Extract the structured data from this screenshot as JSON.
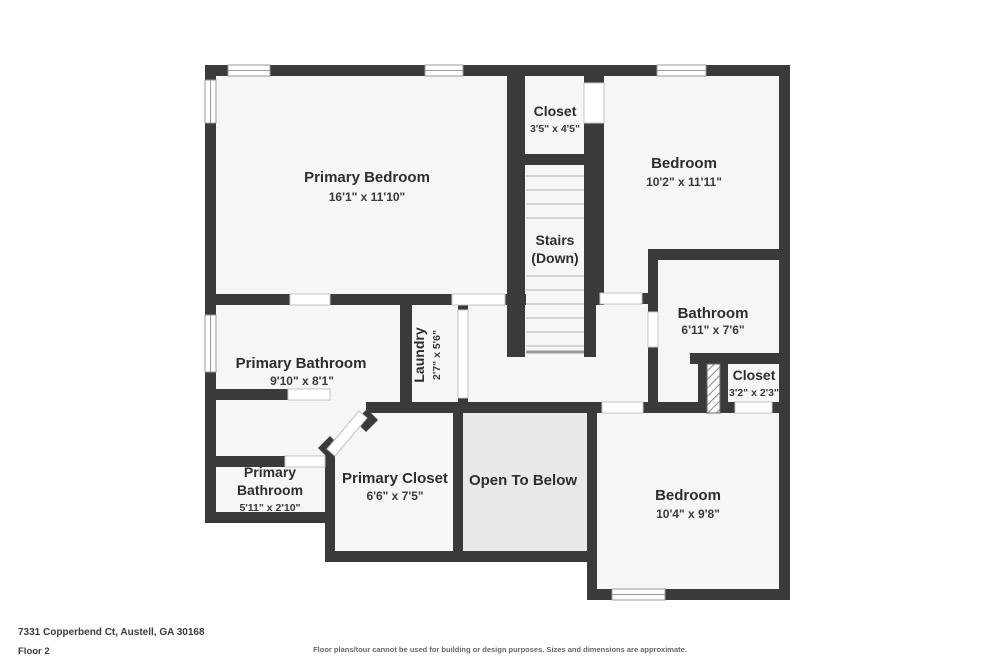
{
  "meta": {
    "title": "Floor plan - Floor 2",
    "colors": {
      "wall": "#3a3a3a",
      "room_fill": "#f6f6f6",
      "open_to_below_fill": "#e9e9e9",
      "step_line": "#c9c9c9",
      "window_outline": "#9a9a9a",
      "background": "#ffffff"
    }
  },
  "floorplan": {
    "rooms": [
      {
        "id": "primary-bedroom",
        "name": "Primary Bedroom",
        "dims": "16'1\" x 11'10\""
      },
      {
        "id": "closet-top",
        "name": "Closet",
        "dims": "3'5\" x 4'5\""
      },
      {
        "id": "stairs",
        "line1": "Stairs",
        "line2": "(Down)"
      },
      {
        "id": "bedroom-top-right",
        "name": "Bedroom",
        "dims": "10'2\" x 11'11\""
      },
      {
        "id": "bathroom",
        "name": "Bathroom",
        "dims": "6'11\" x 7'6\""
      },
      {
        "id": "closet-right",
        "name": "Closet",
        "dims": "3'2\" x 2'3\""
      },
      {
        "id": "laundry",
        "name": "Laundry",
        "dims": "2'7\" x 5'6\""
      },
      {
        "id": "primary-bathroom",
        "name": "Primary Bathroom",
        "dims": "9'10\" x 8'1\""
      },
      {
        "id": "primary-bathroom-small",
        "line1": "Primary",
        "line2": "Bathroom",
        "dims": "5'11\" x 2'10\""
      },
      {
        "id": "primary-closet",
        "name": "Primary Closet",
        "dims": "6'6\" x 7'5\""
      },
      {
        "id": "open-to-below",
        "name": "Open To Below"
      },
      {
        "id": "bedroom-bottom-right",
        "name": "Bedroom",
        "dims": "10'4\" x 9'8\""
      }
    ]
  },
  "footer": {
    "address": "7331 Copperbend Ct, Austell, GA 30168",
    "floor_label": "Floor 2",
    "disclaimer": "Floor plans/tour cannot be used for building or design purposes. Sizes and dimensions are approximate."
  }
}
